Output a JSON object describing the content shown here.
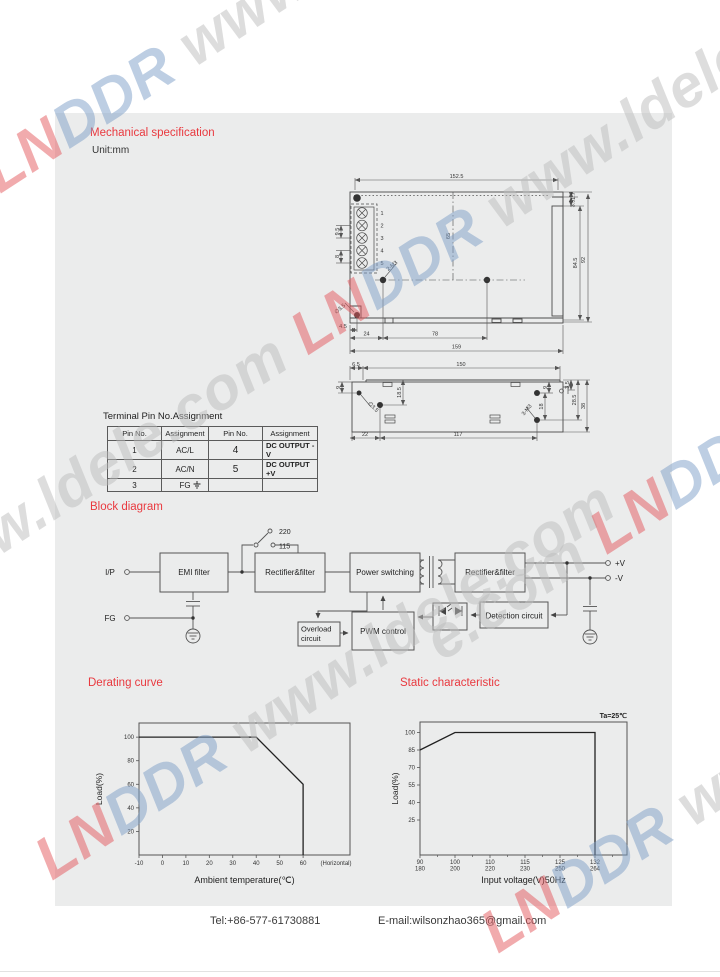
{
  "sections": {
    "mech_title": "Mechanical specification",
    "unit": "Unit:mm",
    "block_title": "Block diagram"
  },
  "pin_table": {
    "title": "Terminal Pin No.Assignment",
    "headers": [
      "Pin No.",
      "Assignment",
      "Pin No.",
      "Assignment"
    ],
    "rows": [
      [
        "1",
        "AC/L",
        "4",
        "DC OUTPUT -V"
      ],
      [
        "2",
        "AC/N",
        "5",
        "DC OUTPUT +V"
      ],
      [
        "3",
        "FG",
        "",
        ""
      ]
    ]
  },
  "mech_top": {
    "d1525": "152.5",
    "d17": "1.7",
    "d35": "3.5",
    "d845": "84.5",
    "d92": "92",
    "d65": "65",
    "d95": "9.5",
    "d8": "8",
    "m3": "2-M3",
    "phi": "∅3.5",
    "d45": "4.5",
    "d24": "24",
    "d78": "78",
    "d159": "159",
    "pins": [
      "1",
      "2",
      "3",
      "4",
      "5"
    ]
  },
  "mech_side": {
    "d65": "6.5",
    "d150": "150",
    "d9l": "9",
    "phi": "∅3.5",
    "d185": "18.5",
    "d9r": "9",
    "d18": "18",
    "m3": "3-M3",
    "d35": "3.5",
    "d285": "28.5",
    "d38": "38",
    "d22": "22",
    "d117": "117"
  },
  "block": {
    "ip": "I/P",
    "fg": "FG",
    "emi": "EMI filter",
    "v220": "220",
    "v115": "115",
    "rect1": "Rectifier&filter",
    "power": "Power switching",
    "rect2": "Rectifier&filter",
    "overload1": "Overload",
    "overload2": "circuit",
    "pwm": "PWM control",
    "detect": "Detection circuit",
    "vp": "+V",
    "vm": "-V"
  },
  "footer": {
    "tel": "Tel:+86-577-61730881",
    "email": "E-mail:wilsonzhao365@gmail.com"
  },
  "watermark": {
    "red": "LN",
    "blue": "DDR",
    "grey": " www.ldele.com ",
    "grey_tail": "e.com "
  },
  "chart_data": [
    {
      "type": "line",
      "title": "Derating curve",
      "xlabel": "Ambient temperature(℃)",
      "ylabel": "Load(%)",
      "x": [
        -10,
        40,
        60,
        60
      ],
      "y": [
        100,
        100,
        60,
        0
      ],
      "xticks": [
        -10,
        0,
        10,
        20,
        30,
        40,
        50,
        60
      ],
      "xtick_suffix": "(Horizontal)",
      "yticks": [
        20,
        40,
        60,
        80,
        100
      ],
      "xlim": [
        -10,
        80
      ],
      "ylim": [
        0,
        112
      ],
      "grid": false,
      "legend": null,
      "line_color": "#222222"
    },
    {
      "type": "line",
      "title": "Static characteristic",
      "annotation": "Ta=25℃",
      "xlabel": "Input voltage(V)50Hz",
      "ylabel": "Load(%)",
      "x": [
        90,
        100,
        132,
        132
      ],
      "y": [
        85,
        100,
        100,
        -5
      ],
      "xticks": [
        [
          90,
          180
        ],
        [
          100,
          200
        ],
        [
          110,
          220
        ],
        [
          115,
          230
        ],
        [
          125,
          250
        ],
        [
          132,
          264
        ]
      ],
      "yticks": [
        25,
        40,
        55,
        70,
        85,
        100
      ],
      "ylim": [
        -5,
        109
      ],
      "grid": false,
      "legend": null,
      "line_color": "#222222"
    }
  ]
}
